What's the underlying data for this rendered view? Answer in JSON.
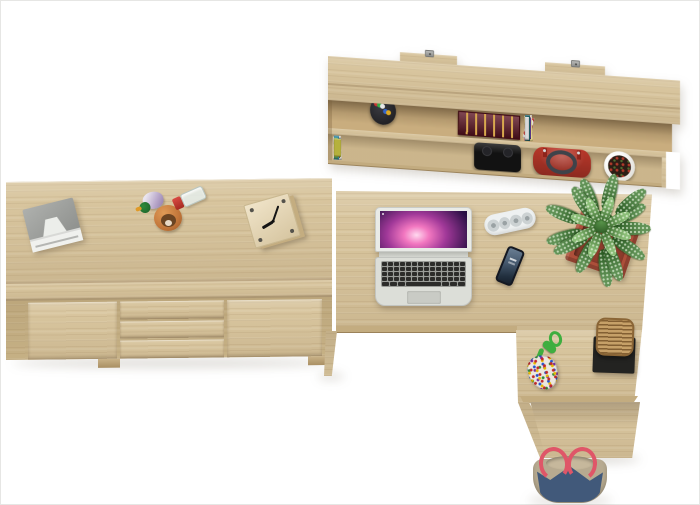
{
  "scene": {
    "type": "product-render",
    "description": "Top-down view of a Sonoma oak home-office furniture set: wall-mounted bookshelf, sideboard with two doors and three drawers, and an L-shaped corner desk with accessories, on a white background",
    "background_color": "#ffffff",
    "wood_color": "#d8c59e"
  },
  "bookshelf": {
    "label": "wall-mounted shelf with books",
    "mount_bracket_count": 2,
    "upper_shelf": {
      "pen_cup": {
        "cup_color": "#222226",
        "pen_colors": [
          "#cc3333",
          "#3366cc",
          "#33aa44",
          "#ddaa22",
          "#e8e8e8"
        ]
      },
      "antique_book": {
        "cover_color": "#5d1422",
        "trim_color": "#d8a84e"
      },
      "book_colors": [
        "#43307a",
        "#8fa3d0",
        "#f0eee8",
        "#1c1c22",
        "#23355e",
        "#d8dadf",
        "#e0418c",
        "#b8197c",
        "#f2efe9",
        "#6e1420",
        "#e78ab0",
        "#efe2e0",
        "#c2a36a",
        "#efead8",
        "#8c1a22",
        "#2e6b3a",
        "#9aa05a",
        "#e8d88a",
        "#5c3a8e",
        "#1f5f66",
        "#d9d9d9"
      ]
    },
    "lower_shelf": {
      "book_colors": [
        "#4a4a48",
        "#caa84e",
        "#2f4f8e",
        "#e9e5da",
        "#18181a",
        "#d9d1be",
        "#a03028",
        "#8e8e8c",
        "#d4578c",
        "#2a2a30",
        "#efece3",
        "#1e4f3e",
        "#27988c",
        "#3a6aa0",
        "#6f7a34",
        "#bf3a2b",
        "#3c3c3e",
        "#d8d6cf",
        "#7a4a28",
        "#2e86a8",
        "#57a05a",
        "#b5b13c"
      ],
      "black_case_color": "#121212",
      "handbag_color": "#c23a2c",
      "handbag_handle_color": "#3f434a",
      "planter": {
        "pot_color": "#f2f1ed",
        "soil_color": "#2c1d15"
      }
    }
  },
  "sideboard": {
    "label": "sideboard with 2 doors and 3 drawers",
    "door_count": 2,
    "drawer_count": 3,
    "items": {
      "printer": {
        "top_color": "#9fa19e",
        "body_color": "#f0f1ee"
      },
      "duck_figurine": {
        "head_color": "#2e8b3b",
        "body_color": "#c9bad6"
      },
      "dog_figurine": {
        "body_color": "#c2763a",
        "face_color": "#6b4422"
      },
      "perfume_bottle": {
        "glass_color": "#e4ece8",
        "cap_color": "#c03333"
      },
      "cube_clock": {
        "wood_color": "#e3d5b4",
        "hand_color": "#151515"
      }
    }
  },
  "desk": {
    "label": "L-shaped corner desk with pedestal",
    "items": {
      "laptop": {
        "body_color": "#dcded8",
        "key_color": "#2c2c2a",
        "wallpaper_colors": [
          "#2a1045",
          "#a03898",
          "#f277c0",
          "#ffd9ef"
        ]
      },
      "speaker": {
        "body_color": "#eef1f1",
        "grille_color": "#ccd2d3",
        "grille_count": 4
      },
      "smartphone": {
        "body_color": "#141822",
        "screen_top_color": "#6b7f94",
        "screen_bottom_color": "#22303f"
      },
      "plant": {
        "leaf_color_dark": "#3e7a31",
        "leaf_color_light": "#72b05a",
        "pot_color": "#ad4f3a",
        "leaf_count": 13,
        "inner_leaf_count": 8
      },
      "bead_pouch": {
        "cord_color": "#3fae3f",
        "bead_colors": [
          "#c22828",
          "#2255cc",
          "#e6b800",
          "#7a2ca0",
          "#2e8b3a"
        ]
      },
      "wicker_stool": {
        "seat_color": "#b68d52",
        "base_color": "#232321"
      }
    }
  },
  "floor_items": {
    "tote_bag": {
      "body_color": "#41597a",
      "trim_color": "#b7aa90",
      "strap_color": "#df5668"
    }
  }
}
